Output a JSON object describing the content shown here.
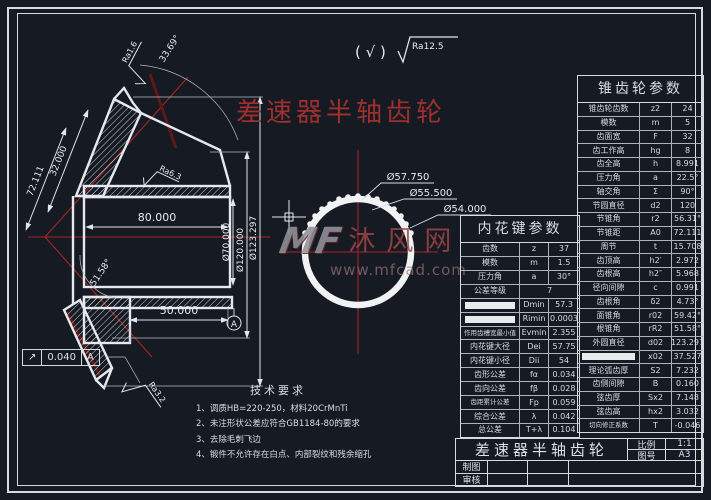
{
  "header": {
    "title": "差速器半轴齿轮",
    "surface_prefix": "( √ )",
    "surface_value": "Ra12.5"
  },
  "left_view": {
    "dim_80": "80.000",
    "dim_50": "50.000",
    "dia_70": "Ø70.000",
    "dia_120": "Ø120.000",
    "dia_123": "Ø123.297",
    "dim_72": "72.111",
    "dim_32": "32.000",
    "ang_3369": "33.69°",
    "ang_5158": "51.58°",
    "ra16": "Ra1.6",
    "ra63": "Ra6.3",
    "ra32": "Ra3.2",
    "datum": "A"
  },
  "tolerance_frame": {
    "symbol": "↗",
    "value": "0.040",
    "datum": "A"
  },
  "circle_view": {
    "dia_5775": "Ø57.750",
    "dia_555": "Ø55.500",
    "dia_54": "Ø54.000"
  },
  "watermark": {
    "logo": "MF",
    "name": "沐风网",
    "url": "www.mfcad.com"
  },
  "spline_table": {
    "title": "内花键参数",
    "rows": [
      {
        "label": "齿数",
        "sym": "z",
        "val": "37"
      },
      {
        "label": "模数",
        "sym": "m",
        "val": "1.5"
      },
      {
        "label": "压力角",
        "sym": "a",
        "val": "30°"
      },
      {
        "label": "公差等级",
        "span": true,
        "val": "7"
      },
      {
        "redacted": true,
        "sym": "Dmin",
        "val": "57.3"
      },
      {
        "redacted": true,
        "sym": "Rimin",
        "val": "0.0003"
      },
      {
        "label": "作用齿槽宽最小值",
        "sym": "Evmin",
        "val": "2.355",
        "small": true
      },
      {
        "label": "内花键大径",
        "sym": "Dei",
        "val": "57.75"
      },
      {
        "label": "内花键小径",
        "sym": "Dii",
        "val": "54"
      },
      {
        "label": "齿形公差",
        "sym": "fα",
        "val": "0.034"
      },
      {
        "label": "齿向公差",
        "sym": "fβ",
        "val": "0.028"
      },
      {
        "label": "齿距累计公差",
        "sym": "Fp",
        "val": "0.059",
        "small": true
      },
      {
        "label": "综合公差",
        "sym": "λ",
        "val": "0.042"
      },
      {
        "label": "总公差",
        "sym": "T+λ",
        "val": "0.104"
      }
    ]
  },
  "bevel_table": {
    "title": "锥齿轮参数",
    "rows": [
      {
        "label": "锥齿轮齿数",
        "sym": "z2",
        "val": "24"
      },
      {
        "label": "模数",
        "sym": "m",
        "val": "5"
      },
      {
        "label": "齿面宽",
        "sym": "F",
        "val": "32"
      },
      {
        "label": "齿工作高",
        "sym": "hg",
        "val": "8"
      },
      {
        "label": "齿全高",
        "sym": "h",
        "val": "8.991"
      },
      {
        "label": "压力角",
        "sym": "a",
        "val": "22.5°"
      },
      {
        "label": "轴交角",
        "sym": "Σ",
        "val": "90°"
      },
      {
        "label": "节圆直径",
        "sym": "d2",
        "val": "120"
      },
      {
        "label": "节锥角",
        "sym": "r2",
        "val": "56.31°"
      },
      {
        "label": "节锥距",
        "sym": "A0",
        "val": "72.111"
      },
      {
        "label": "周节",
        "sym": "t",
        "val": "15.708"
      },
      {
        "label": "齿顶高",
        "sym": "h2′",
        "val": "2.972"
      },
      {
        "label": "齿根高",
        "sym": "h2″",
        "val": "5.968"
      },
      {
        "label": "径向间隙",
        "sym": "c",
        "val": "0.991"
      },
      {
        "label": "齿根角",
        "sym": "δ2",
        "val": "4.73°"
      },
      {
        "label": "面锥角",
        "sym": "r02",
        "val": "59.42°"
      },
      {
        "label": "根锥角",
        "sym": "rR2",
        "val": "51.58°"
      },
      {
        "label": "外圆直径",
        "sym": "d02",
        "val": "123.297"
      },
      {
        "redacted": true,
        "sym": "x02",
        "val": "37.527"
      },
      {
        "label": "理论弧齿厚",
        "sym": "S2",
        "val": "7.232"
      },
      {
        "label": "齿侧间隙",
        "sym": "B",
        "val": "0.160"
      },
      {
        "label": "弦齿厚",
        "sym": "Sx2",
        "val": "7.148"
      },
      {
        "label": "弦齿高",
        "sym": "hx2",
        "val": "3.032"
      },
      {
        "label": "切向修正系数",
        "sym": "T",
        "val": "-0.046",
        "small": true
      }
    ]
  },
  "tech_req": {
    "title": "技术要求",
    "items": [
      "1、调质HB=220-250，材料20CrMnTi",
      "2、未注形状公差应符合GB1184-80的要求",
      "3、去除毛刺飞边",
      "4、锻件不允许存在白点、内部裂纹和残余缩孔"
    ]
  },
  "title_block": {
    "title": "差速器半轴齿轮",
    "scale_label": "比例",
    "scale_value": "1:1",
    "sheet_label": "图号",
    "sheet_value": "A3",
    "drawn_label": "制图",
    "checked_label": "审核"
  }
}
